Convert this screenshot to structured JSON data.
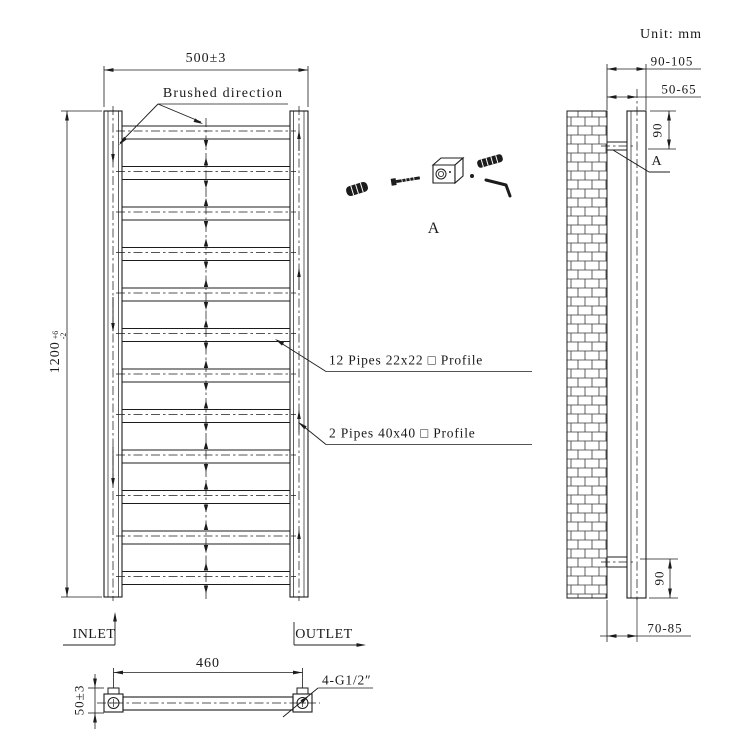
{
  "meta": {
    "unit_note": "Unit: mm"
  },
  "front_view": {
    "width_dim": "500±3",
    "height_dim_value": "1200",
    "height_dim_tol_plus": "+6",
    "height_dim_tol_minus": "-2",
    "brushed_direction_label": "Brushed direction",
    "pipes_small_label": "12 Pipes 22x22 □ Profile",
    "pipes_large_label": "2 Pipes 40x40 □ Profile",
    "inlet_label": "INLET",
    "outlet_label": "OUTLET"
  },
  "bottom_view": {
    "ports_spacing_dim": "460",
    "port_offset_dim": "50±3",
    "thread_spec_label": "4-G1/2″"
  },
  "side_view": {
    "wall_to_front_dim": "90-105",
    "wall_to_center_top_dim": "50-65",
    "top_bracket_dim": "90",
    "bottom_bracket_dim": "90",
    "wall_to_center_bottom_dim": "70-85",
    "detail_marker": "A"
  },
  "detail_a": {
    "label": "A"
  },
  "colors": {
    "line": "#1c1c1c",
    "background": "#ffffff"
  }
}
